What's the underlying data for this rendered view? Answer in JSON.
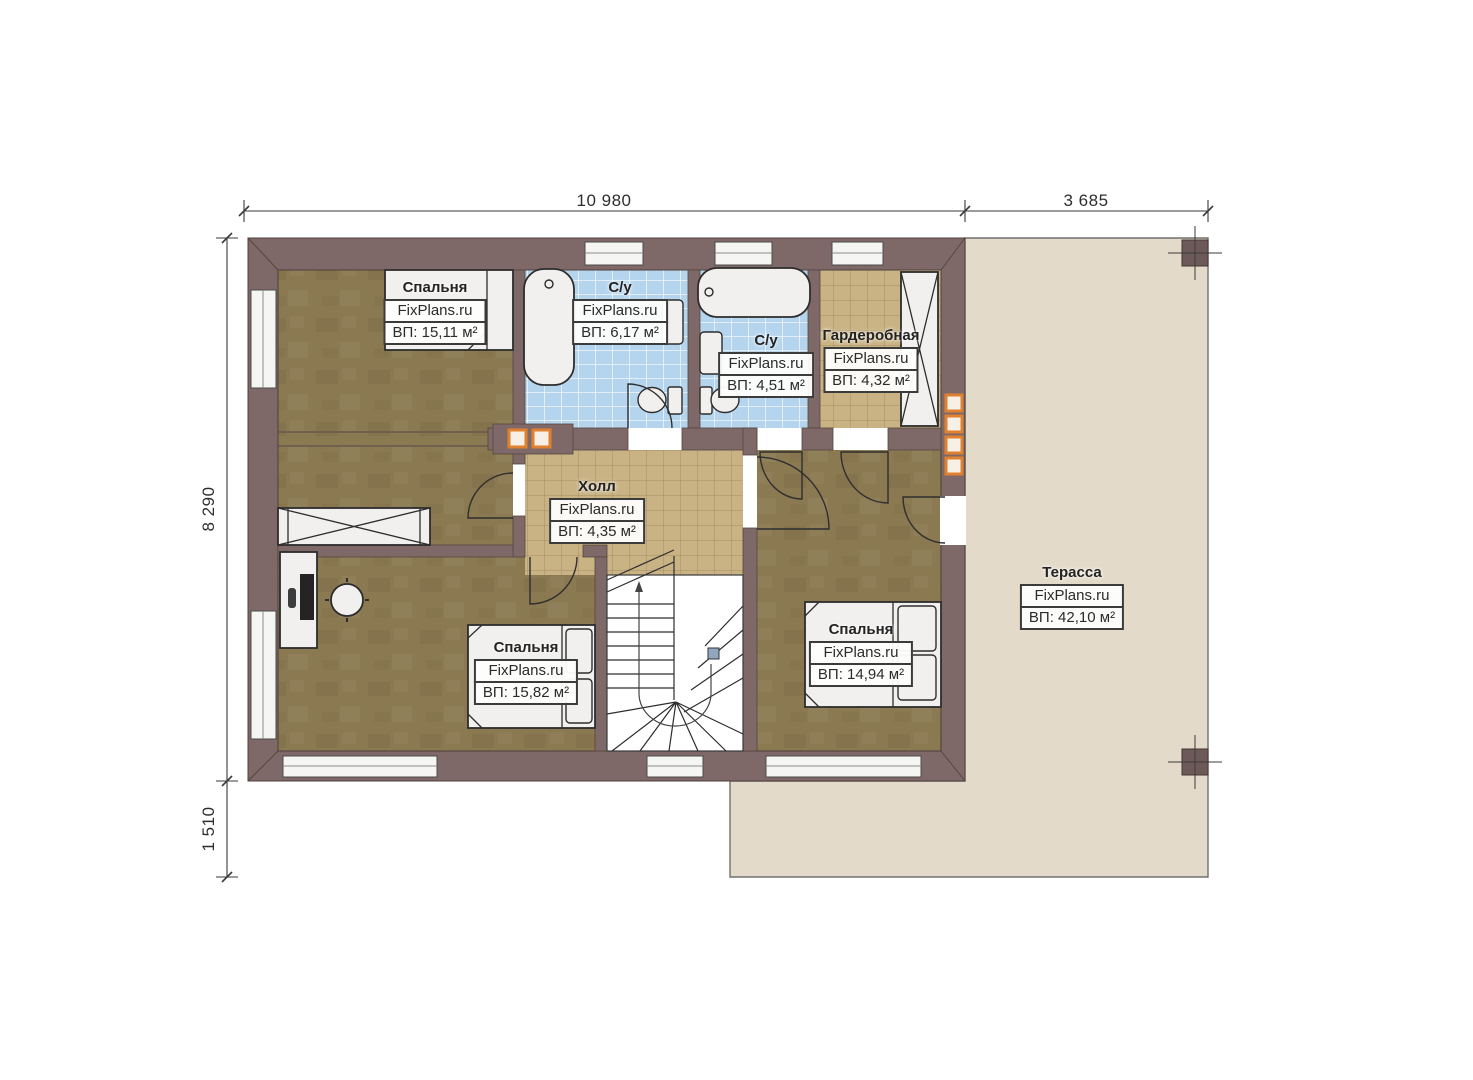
{
  "watermark": "FixPlans.ru",
  "rooms": [
    {
      "key": "bedroom-top-left",
      "name": "Спальня",
      "area": "ВП: 15,11 м²"
    },
    {
      "key": "bathroom-top",
      "name": "С/у",
      "area": "ВП: 6,17 м²"
    },
    {
      "key": "bathroom-middle",
      "name": "С/у",
      "area": "ВП: 4,51 м²"
    },
    {
      "key": "wardrobe",
      "name": "Гардеробная",
      "area": "ВП: 4,32 м²"
    },
    {
      "key": "hall",
      "name": "Холл",
      "area": "ВП: 4,35 м²"
    },
    {
      "key": "bedroom-bottom-left",
      "name": "Спальня",
      "area": "ВП: 15,82 м²"
    },
    {
      "key": "bedroom-bottom-right",
      "name": "Спальня",
      "area": "ВП: 14,94 м²"
    },
    {
      "key": "terrace",
      "name": "Терасса",
      "area": "ВП: 42,10 м²"
    }
  ],
  "dimensions": {
    "top": [
      "10 980",
      "3 685"
    ],
    "left": [
      "8 290",
      "1 510"
    ]
  },
  "colors": {
    "wall": "#7e6968",
    "wood_floor": "#8a7951",
    "tile_blue": "#b5d5ef",
    "tile_beige": "#c9b384",
    "terrace": "#e4dac9",
    "accent_orange": "#e0812f"
  }
}
